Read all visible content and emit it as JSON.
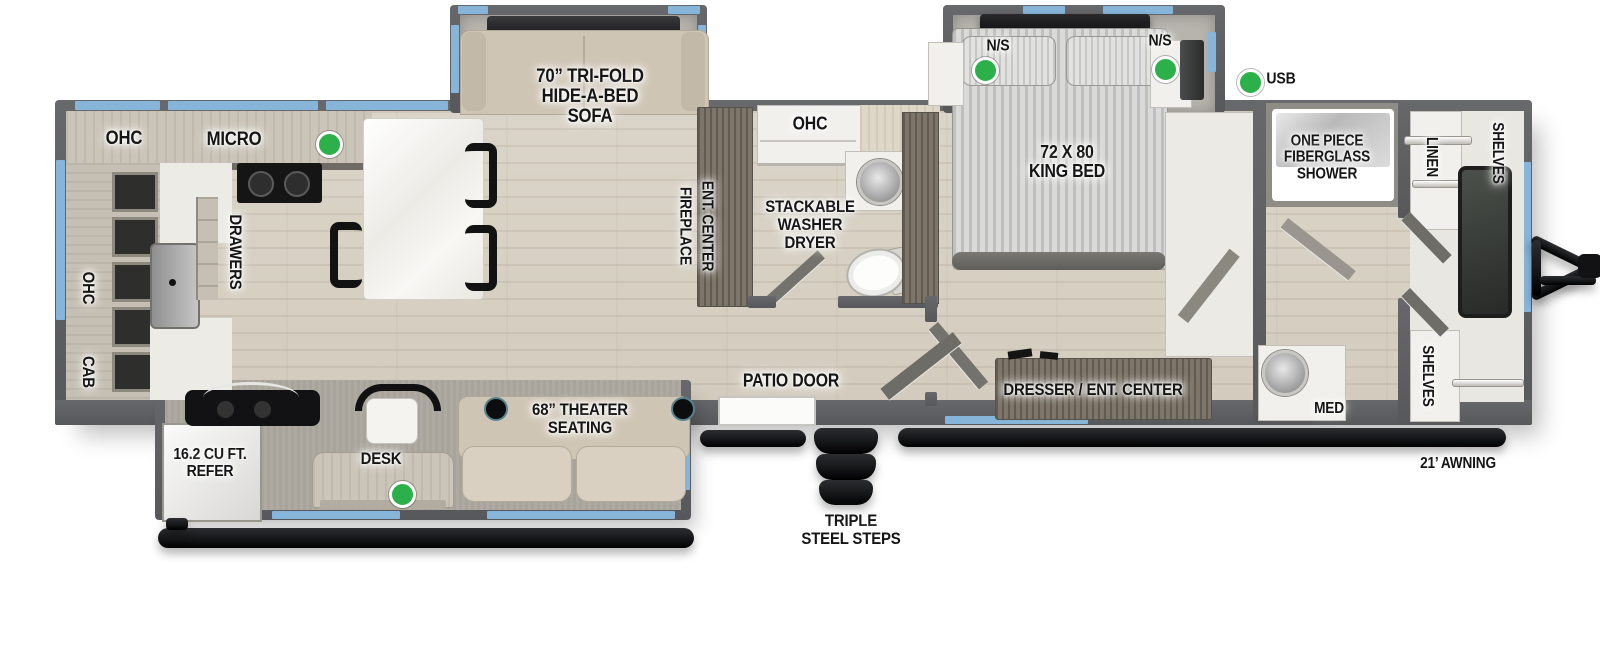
{
  "colors": {
    "accent_green": "#2cb04a",
    "window_blue": "#87b5da",
    "wall_gray": "#5d5e61",
    "floor_wood": "#d8d2c6",
    "furniture_beige": "#cfc5b4"
  },
  "labels": {
    "kitchen_ohc": "OHC",
    "micro": "MICRO",
    "left_ohc": "OHC",
    "cab": "CAB",
    "drawers": "DRAWERS",
    "sofa": "70” TRI-FOLD\nHIDE-A-BED\nSOFA",
    "fireplace": "FIREPLACE",
    "ent_center": "ENT. CENTER",
    "bath_ohc": "OHC",
    "washer_dryer": "STACKABLE\nWASHER\nDRYER",
    "patio_door": "PATIO DOOR",
    "steps": "TRIPLE\nSTEEL STEPS",
    "ns_left": "N/S",
    "ns_right": "N/S",
    "king_bed": "72 X 80\nKING BED",
    "usb": "USB",
    "shower": "ONE PIECE\nFIBERGLASS\nSHOWER",
    "linen": "LINEN",
    "shelves_top": "SHELVES",
    "shelves_bottom": "SHELVES",
    "med": "MED",
    "dresser": "DRESSER / ENT. CENTER",
    "awning": "21’ AWNING",
    "refer": "16.2 CU FT.\nREFER",
    "desk": "DESK",
    "theater": "68” THEATER\nSEATING"
  }
}
